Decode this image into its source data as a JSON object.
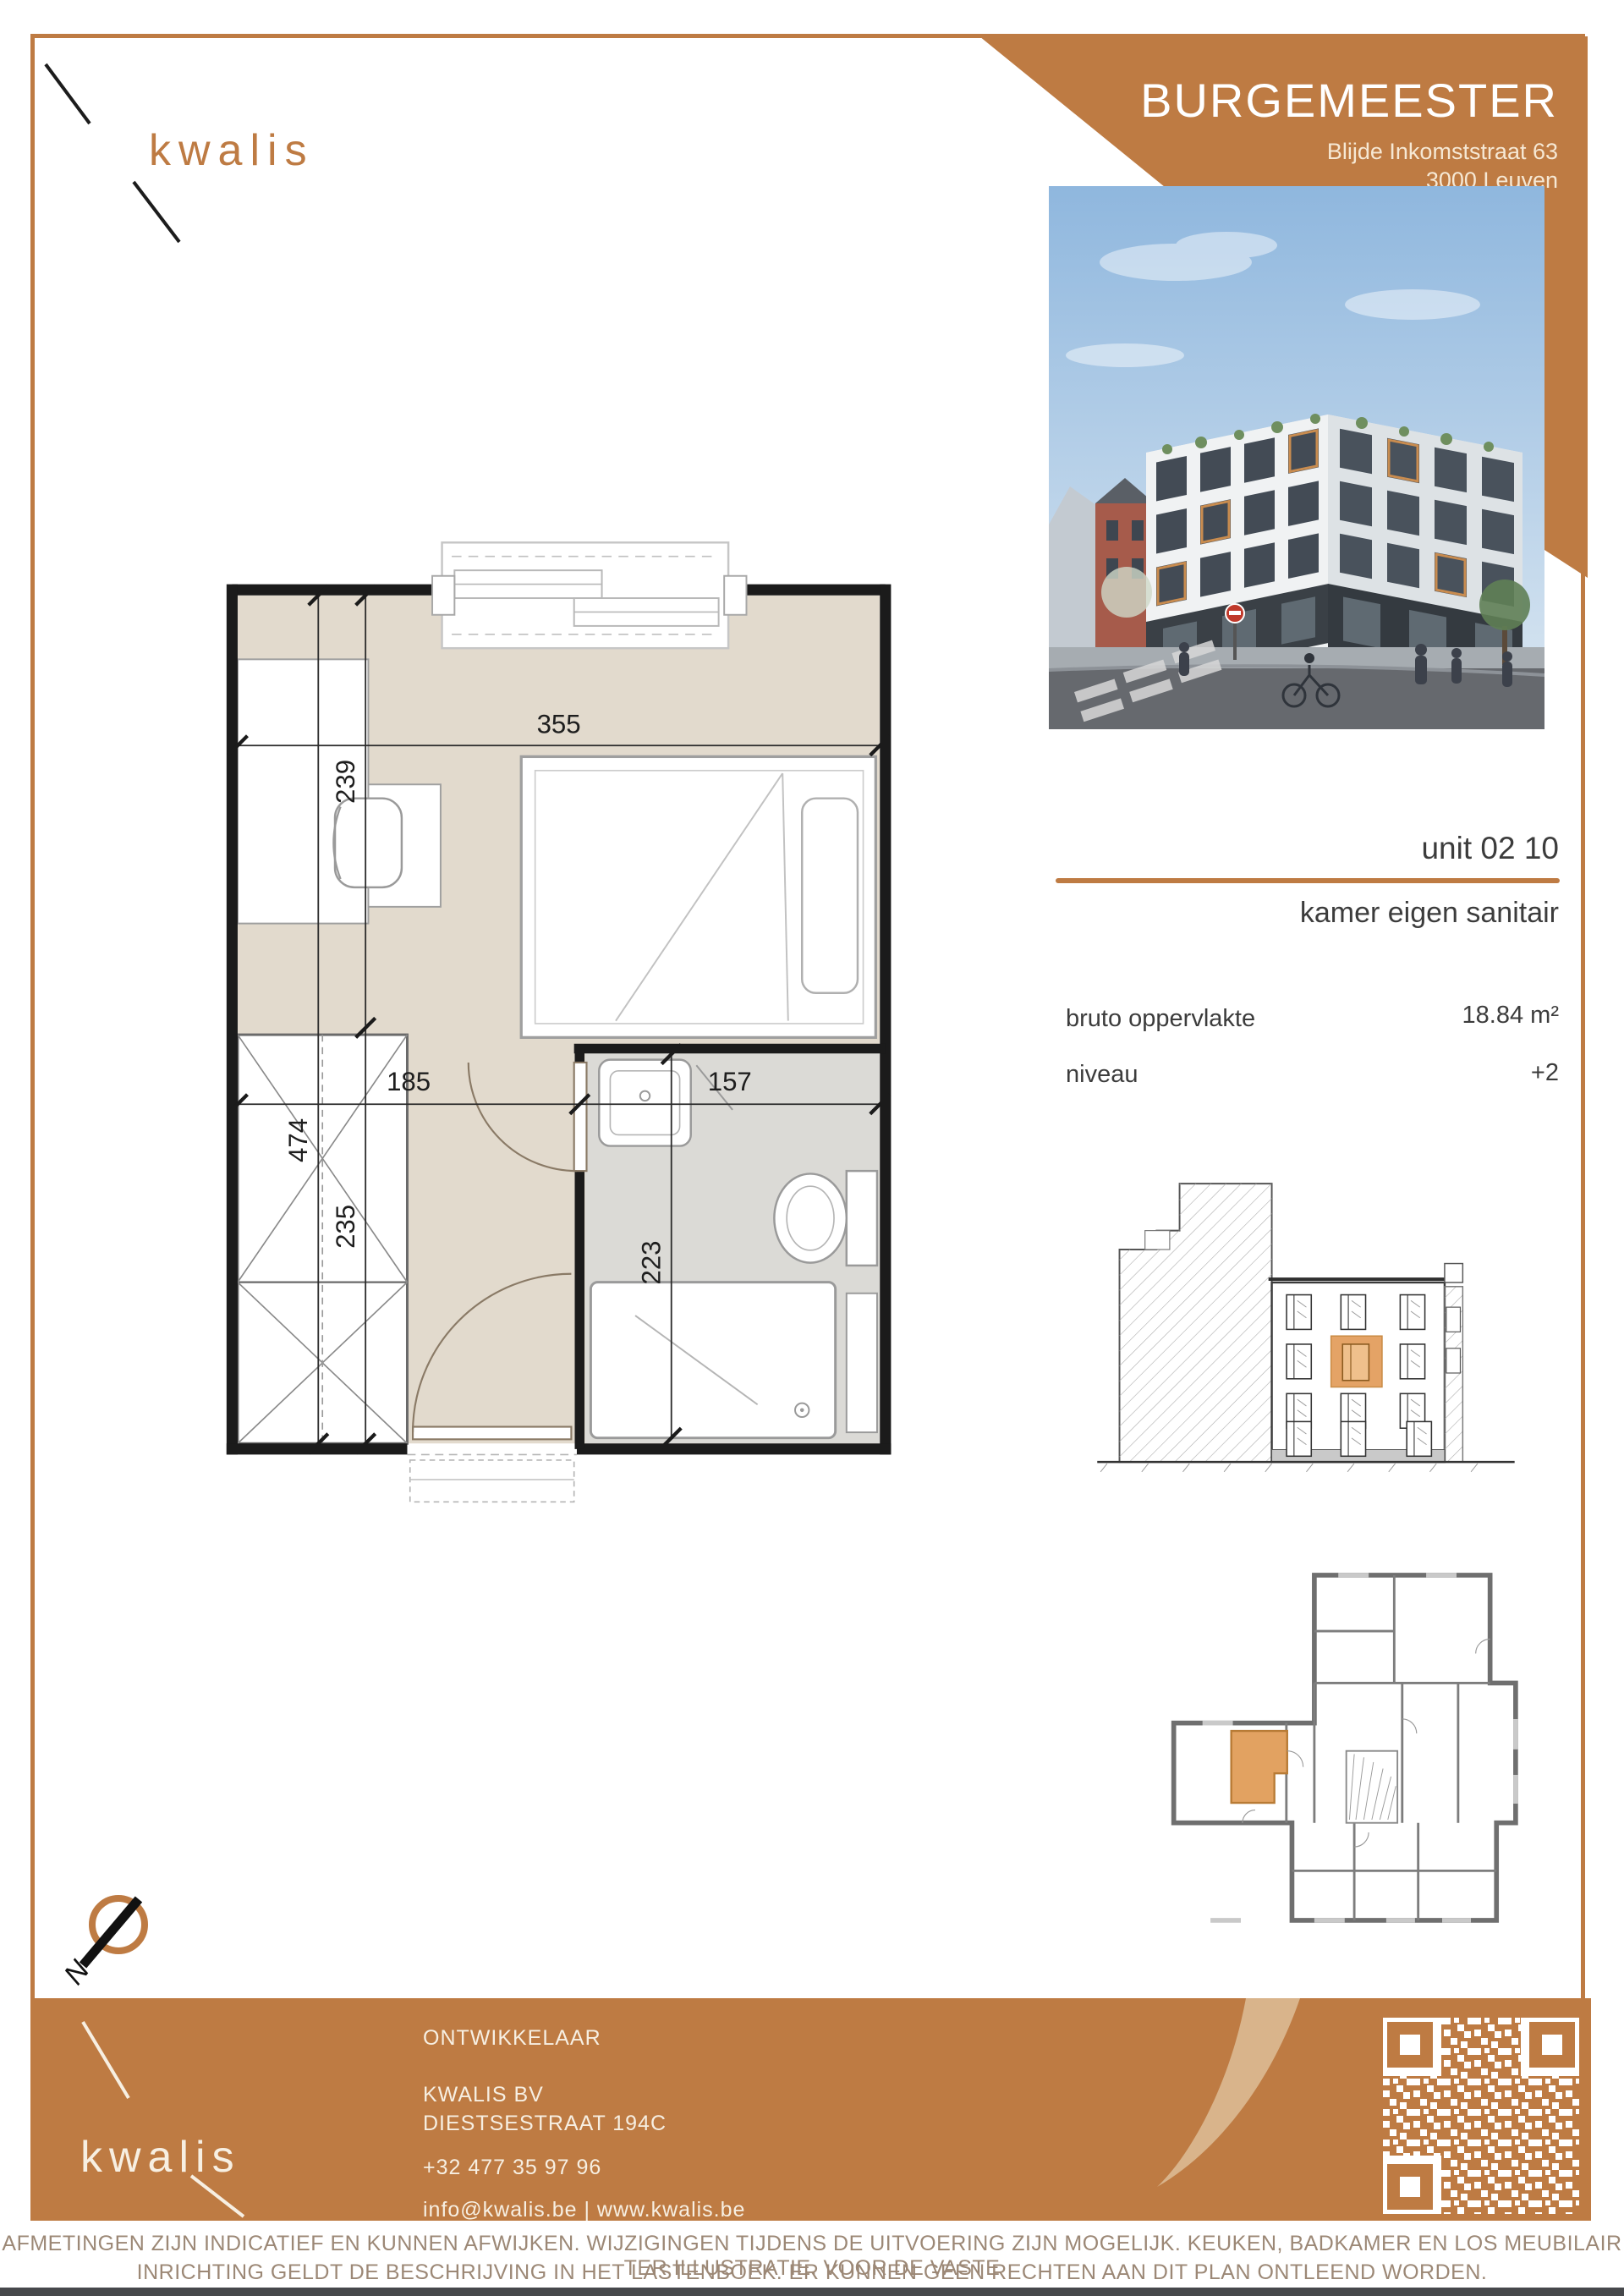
{
  "logo": {
    "brand": "kwalis"
  },
  "header": {
    "title": "BURGEMEESTER",
    "address_line1": "Blijde Inkomststraat 63",
    "address_line2": "3000 Leuven"
  },
  "unit": {
    "number": "unit 02 10",
    "type": "kamer eigen sanitair",
    "area_label": "bruto oppervlakte",
    "area_value": "18.84 m²",
    "level_label": "niveau",
    "level_value": "+2"
  },
  "plan": {
    "dims": {
      "width": "355",
      "depth_total": "474",
      "depth_upper": "239",
      "depth_lower": "235",
      "room_width": "185",
      "bath_width": "157",
      "bath_depth": "223"
    }
  },
  "compass": {
    "north": "N"
  },
  "footer": {
    "brand": "kwalis",
    "role_label": "ONTWIKKELAAR",
    "company": "KWALIS BV",
    "street": "DIESTSESTRAAT 194C",
    "phone": "+32 477 35 97 96",
    "contact_line": "info@kwalis.be  |  www.kwalis.be"
  },
  "disclaimer": {
    "line1": "AFMETINGEN ZIJN INDICATIEF EN KUNNEN AFWIJKEN. WIJZIGINGEN TIJDENS DE UITVOERING ZIJN MOGELIJK. KEUKEN, BADKAMER EN LOS MEUBILAIR TER ILLUSTRATIE. VOOR DE VASTE",
    "line2": "INRICHTING GELDT DE BESCHRIJVING IN HET LASTENBOEK. ER KUNNEN GEEN RECHTEN AAN DIT PLAN ONTLEEND WORDEN."
  },
  "colors": {
    "accent": "#BE7B43",
    "highlight": "#E2A261",
    "floor_beige": "#E2DACD",
    "floor_grey": "#DBDAD6"
  }
}
